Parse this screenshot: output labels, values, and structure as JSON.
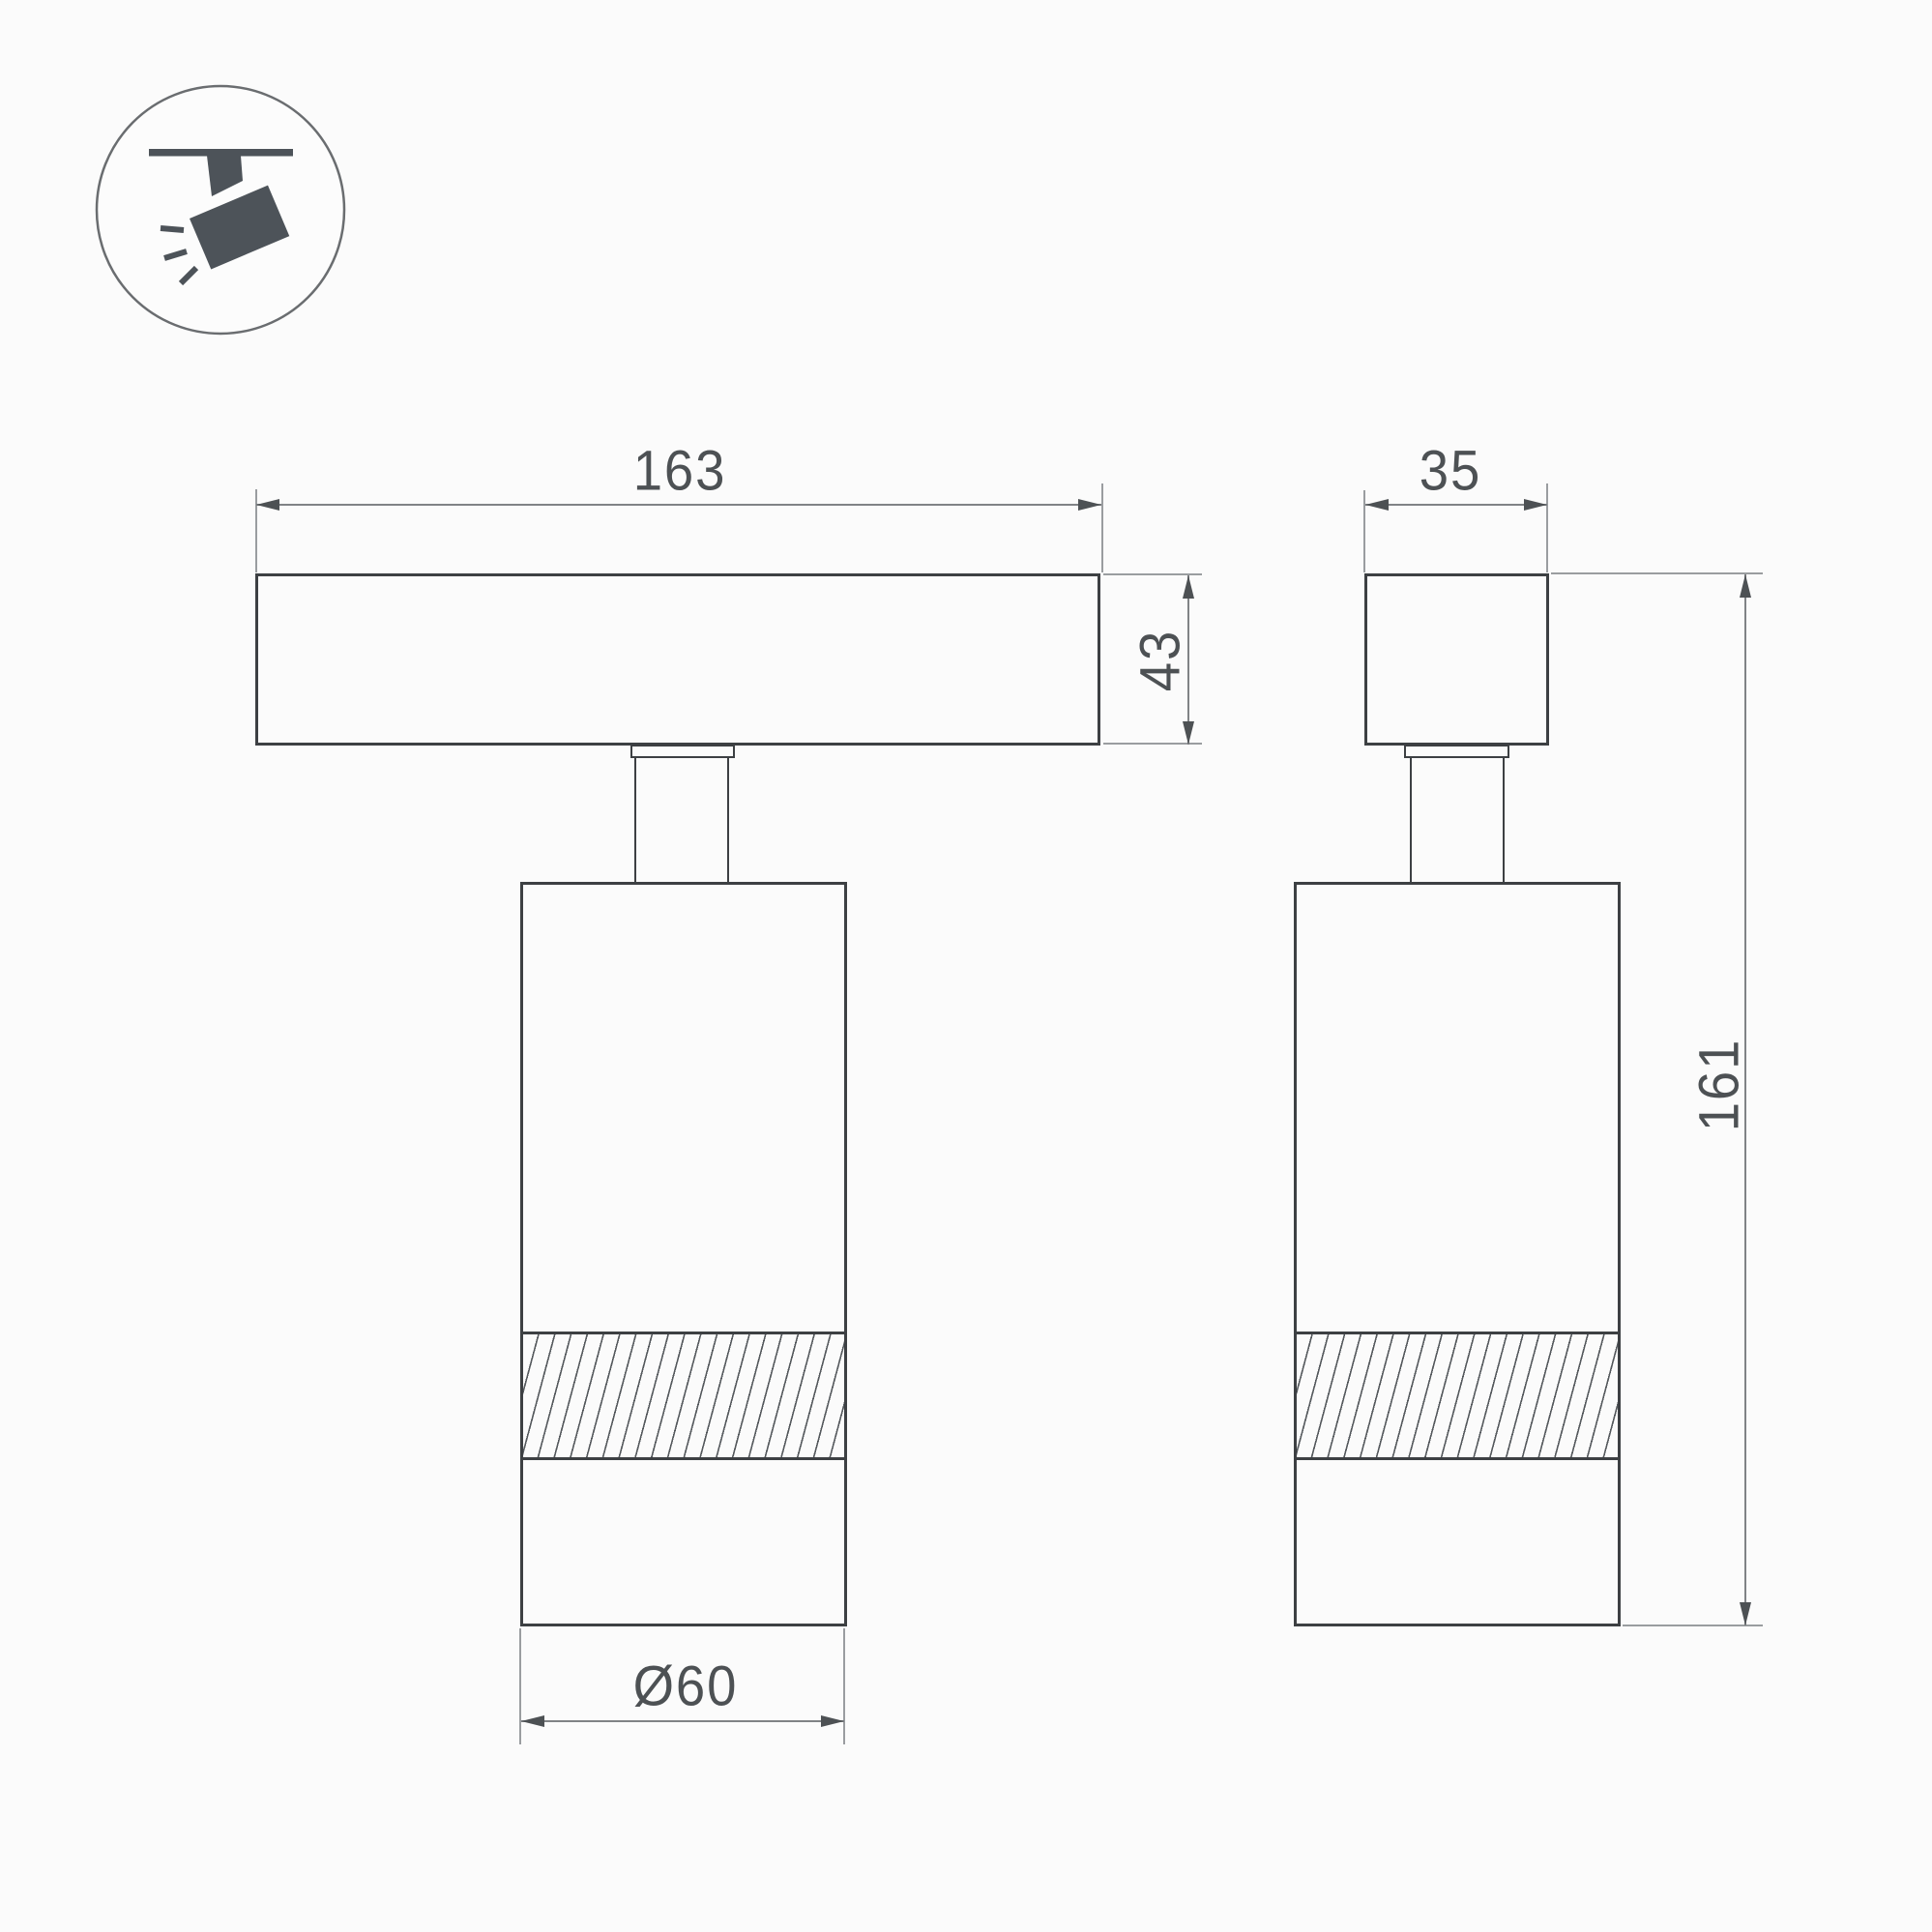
{
  "icon": {
    "name": "track-spotlight-icon",
    "color": "#4d5359"
  },
  "views": {
    "front": "front-view",
    "side": "side-view"
  },
  "dimensions": {
    "track_length": "163",
    "track_height": "43",
    "track_width": "35",
    "fixture_height": "161",
    "body_diameter": "Ø60"
  },
  "colors": {
    "background": "#fbfbfb",
    "outline": "#3d4043",
    "dimension_line": "#808386",
    "text": "#4d5154"
  }
}
